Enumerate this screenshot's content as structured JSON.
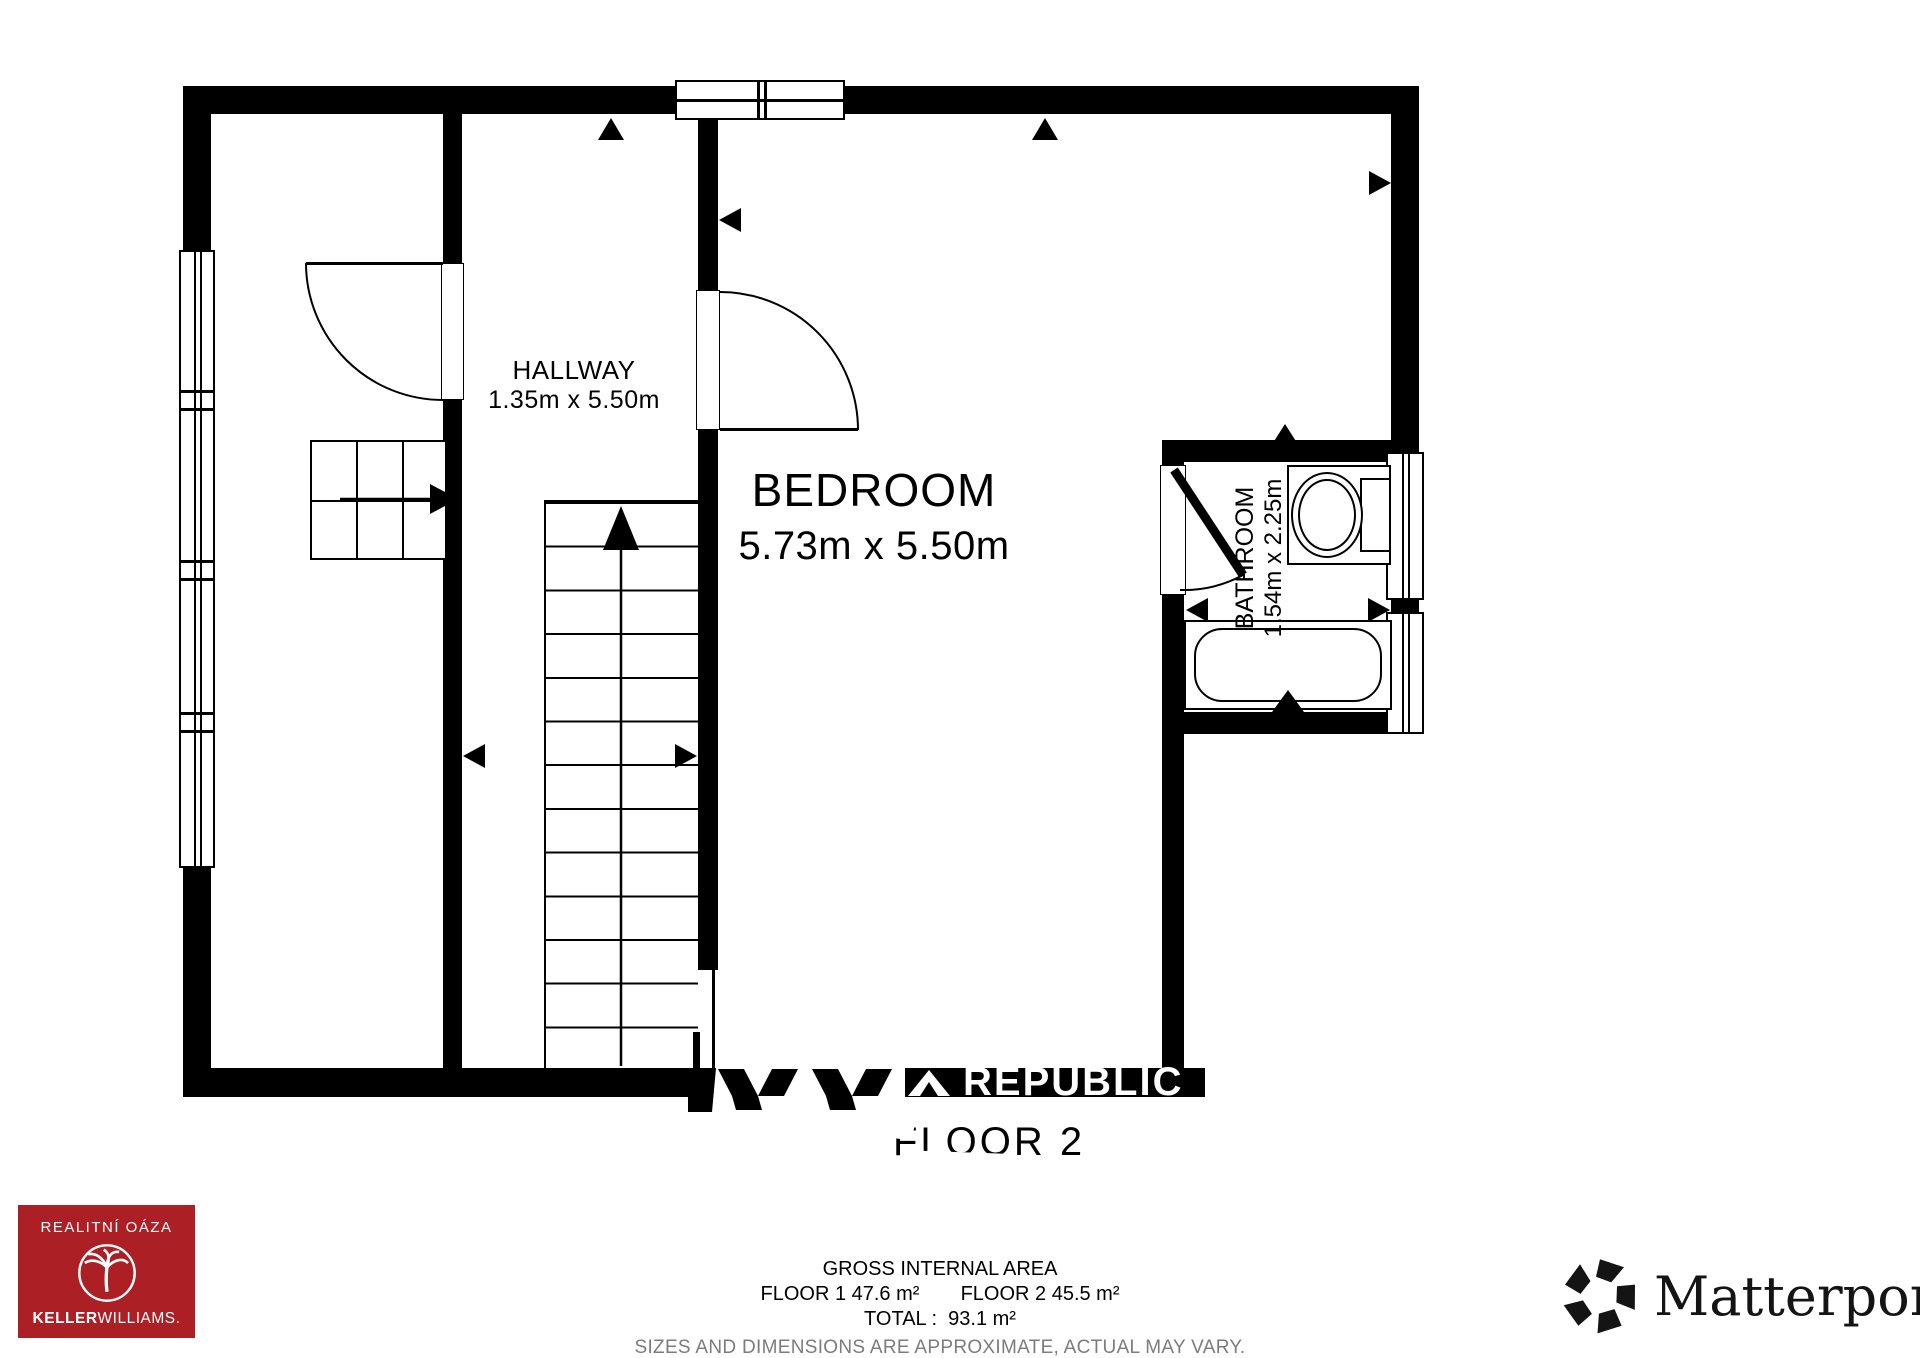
{
  "plan": {
    "floor_label": "FLOOR 2",
    "watermark_text": "REPUBLIC",
    "rooms": [
      {
        "name": "HALLWAY",
        "dimensions": "1.35m x 5.50m"
      },
      {
        "name": "BEDROOM",
        "dimensions": "5.73m x 5.50m"
      },
      {
        "name": "BATHROOM",
        "dimensions": "1.54m x 2.25m"
      }
    ]
  },
  "footer": {
    "area_title": "GROSS INTERNAL AREA",
    "floor1": "FLOOR 1 47.6 m²",
    "floor2": "FLOOR 2 45.5 m²",
    "total": "TOTAL :  93.1 m²",
    "disclaimer": "SIZES AND DIMENSIONS ARE APPROXIMATE, ACTUAL MAY VARY."
  },
  "branding": {
    "agency": {
      "title": "REALITNÍ OÁZA",
      "brand_bold": "KELLER",
      "brand_light": "WILLIAMS.",
      "color": "#AC1F24"
    },
    "matterport": {
      "wordmark": "Matterport",
      "registered": "®"
    }
  }
}
